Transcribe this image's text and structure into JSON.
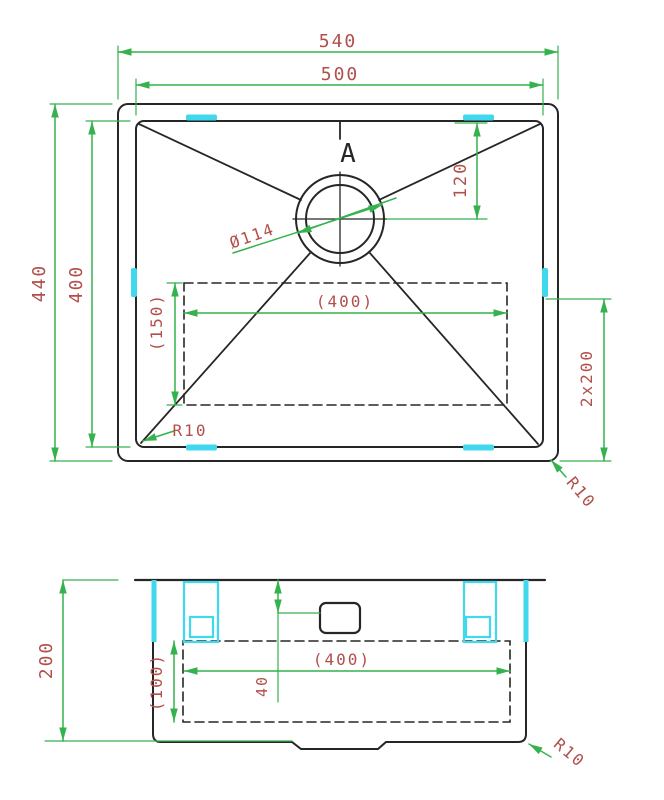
{
  "colors": {
    "line": "#262626",
    "dimension_line": "#35b24d",
    "dimension_text": "#b14f4b",
    "clip": "#3fd8ec"
  },
  "top_view": {
    "dim_overall_width": "540",
    "dim_inner_width": "500",
    "dim_overall_height": "440",
    "dim_inner_height": "400",
    "dim_drain_offset": "120",
    "dim_drain_diameter": "Ø114",
    "dim_base_width": "(400)",
    "dim_base_offset": "(150)",
    "dim_double_depth": "2x200",
    "dim_radius_bottom_left": "R10",
    "dim_radius_bottom_right": "R10",
    "section_label": "A"
  },
  "section_view": {
    "dim_depth": "200",
    "dim_base_height": "(100)",
    "dim_base_width": "(400)",
    "dim_drain_drop": "40",
    "dim_radius": "R10"
  }
}
